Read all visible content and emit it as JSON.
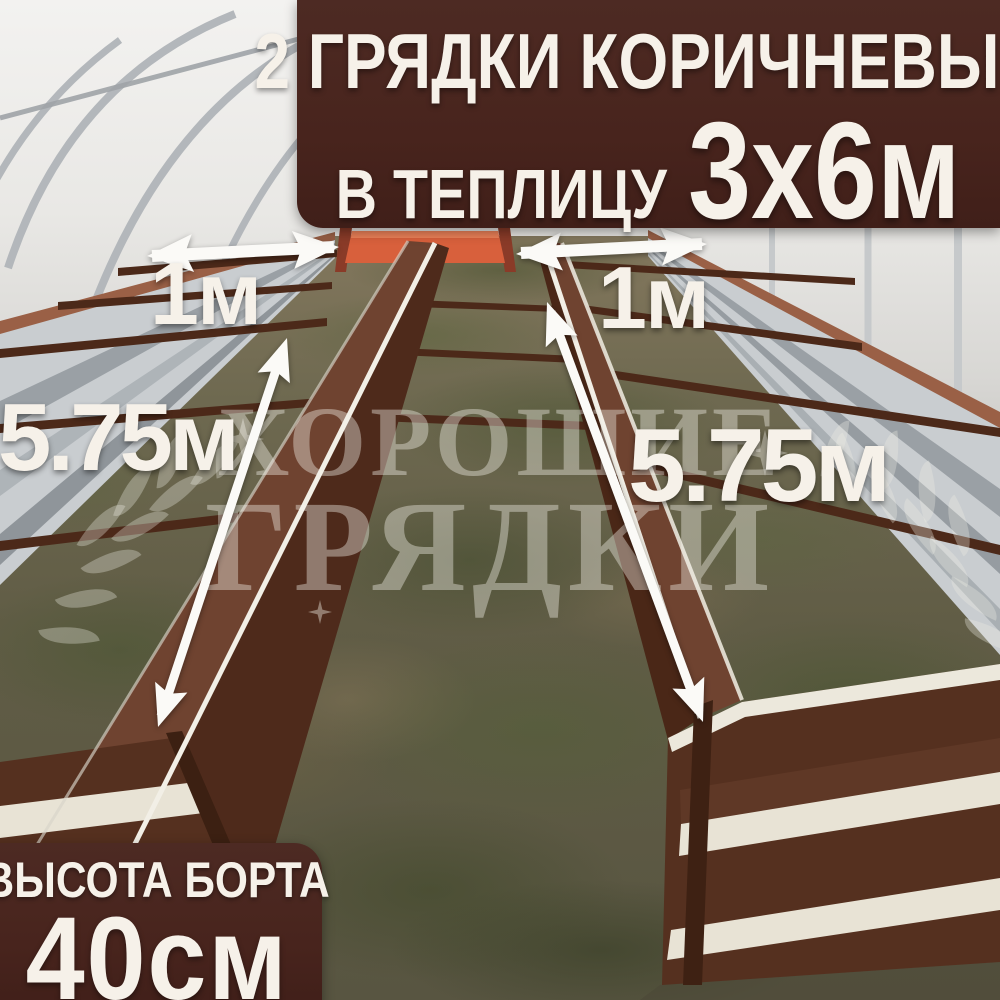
{
  "banner": {
    "line1": "2 ГРЯДКИ КОРИЧНЕВЫЕ",
    "line2_prefix": "В ТЕПЛИЦУ",
    "line2_value": "3х6м"
  },
  "height_badge": {
    "label": "ВЫСОТА БОРТА",
    "value": "40см"
  },
  "dimension_labels": {
    "left_width": "1м",
    "right_width": "1м",
    "left_length": "5.75м",
    "right_length": "5.75м"
  },
  "watermark": {
    "line1": "ХОРОШИЕ",
    "line2": "ГРЯДКИ",
    "icon": "laurel-wreath-icon"
  },
  "colors": {
    "overlay_bg": "#48241d",
    "overlay_text": "#f6f1e9",
    "accent_orange": "#d8603c",
    "bed_brown": "#55301f",
    "metal_silver": "#c9cdd0",
    "watermark_white": "rgba(245,243,236,0.40)"
  }
}
